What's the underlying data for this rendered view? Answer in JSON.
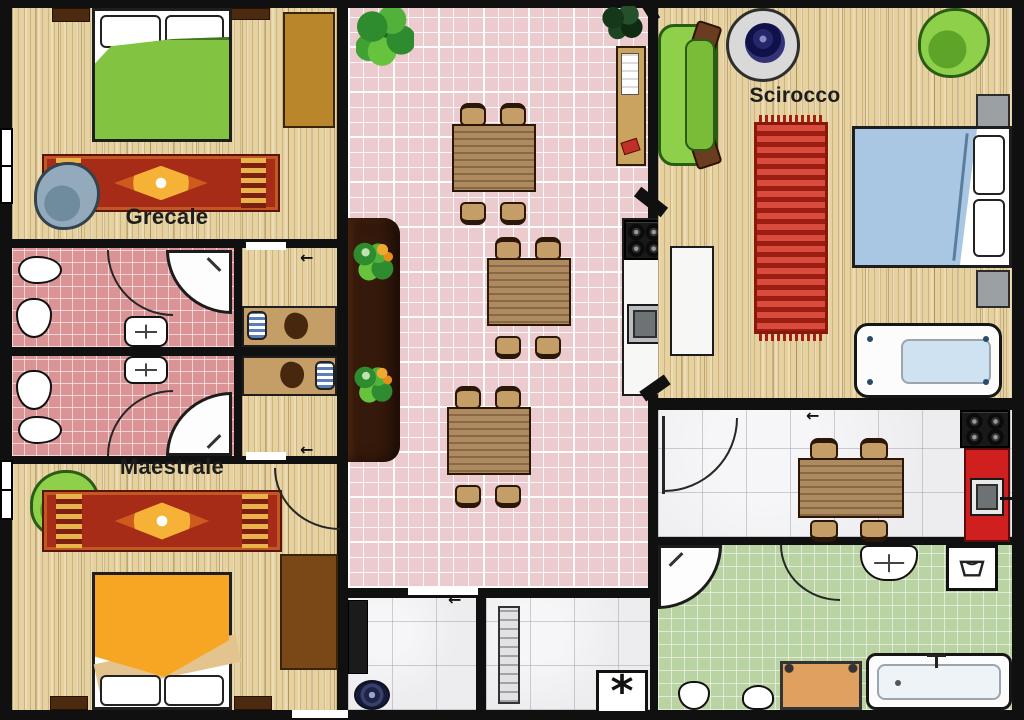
{
  "labels": {
    "grecale": "Grecale",
    "maestrale": "Maestrale",
    "scirocco": "Scirocco"
  },
  "glyphs": {
    "arrow_left": "←",
    "appliance_asterisk": "*"
  },
  "palette": {
    "wall": "#101010",
    "wood": "#e6d2a0",
    "tile_pink": "#eccbce",
    "tile_pink_dark": "#db9496",
    "tile_gray": "#ededf0",
    "tile_green": "#b9d3a3",
    "bed_green": "#82c341",
    "bed_orange": "#f6a623",
    "bed_blue": "#a9c6e2",
    "sofa_green": "#8ed049",
    "armchair_blue": "#92aabb",
    "rug_red": "#a62c18",
    "counter_dark": "#35190b",
    "counter_red": "#cf1f1f",
    "table_wood": "#ad8a5f",
    "chair_wood": "#c59d66",
    "wardrobe_tan": "#b9862c",
    "wardrobe_brown": "#7a4716",
    "nightstand_brown": "#4b2a10",
    "gray_box": "#9aa0a4",
    "outline": "#1e1e1e"
  },
  "furniture": {
    "grecale_room": [
      "double-bed-green",
      "wardrobe",
      "oriental-rug",
      "armchair-blue",
      "nightstand",
      "nightstand"
    ],
    "bathroom_1": [
      "bidet",
      "toilet",
      "door",
      "corner-shower",
      "washbasin"
    ],
    "bathroom_2": [
      "washbasin",
      "toilet",
      "bidet",
      "door",
      "corner-shower"
    ],
    "niche_rooms": [
      "single-bed",
      "single-bed"
    ],
    "maestrale_room": [
      "armchair-green",
      "oriental-rug",
      "door",
      "wardrobe",
      "double-bed-orange",
      "nightstand",
      "nightstand"
    ],
    "dining_hall": [
      "potted-plant",
      "potted-plant-dark",
      "bookshelf",
      "bar-counter",
      "dining-table-x3",
      "chairs",
      "kitchenette-stove",
      "kitchenette-sink"
    ],
    "scirocco_room": [
      "sofa-green",
      "round-rug",
      "armchair-green",
      "striped-rug",
      "double-bed-blue",
      "nightstand",
      "nightstand",
      "sideboard",
      "bathtub"
    ],
    "kitchen": [
      "door",
      "kitchen-table",
      "chairs",
      "stove",
      "red-counter",
      "sink"
    ],
    "green_bathroom": [
      "corner-shower",
      "door",
      "washbasin",
      "washing-machine",
      "toilet",
      "bidet",
      "bath-mat",
      "bathtub"
    ],
    "halls": [
      "dark-cabinet",
      "round-doormat",
      "radiator",
      "vent-appliance"
    ]
  }
}
